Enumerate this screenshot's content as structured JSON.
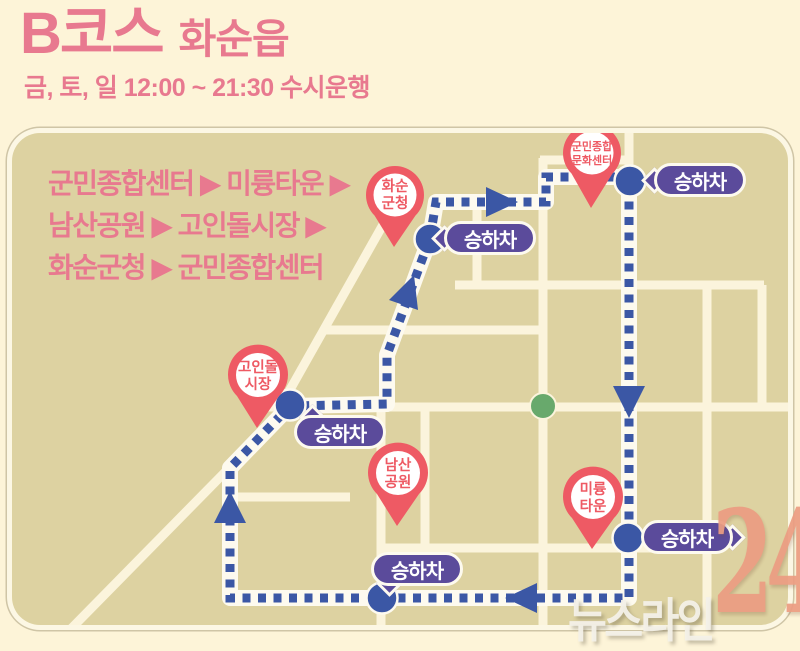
{
  "header": {
    "course": "B코스",
    "area": "화순읍",
    "schedule": "금, 토, 일 12:00 ~ 21:30 수시운행"
  },
  "route_summary": {
    "line1": "군민종합센터 ▶ 미륭타운 ▶",
    "line2": "남산공원 ▶ 고인돌시장 ▶",
    "line3": "화순군청 ▶  군민종합센터"
  },
  "map": {
    "badge_label": "승하차",
    "pins": {
      "hwasun_gunchung": {
        "line1": "화순",
        "line2": "군청"
      },
      "munhwa_center": {
        "line1": "군민종합",
        "line2": "문화센터"
      },
      "goindol_market": {
        "line1": "고인돌",
        "line2": "시장"
      },
      "namsan_park": {
        "line1": "남산",
        "line2": "공원"
      },
      "miryung_town": {
        "line1": "미륭",
        "line2": "타운"
      }
    }
  },
  "watermark": {
    "name": "뉴스라인",
    "number": "24"
  },
  "colors": {
    "title_pink": "#e8798f",
    "pin_red": "#ee5a64",
    "badge_purple": "#5b4b9b",
    "route_blue": "#3b57a5",
    "map_khaki": "#ddd2a1",
    "road_cream": "#fbf4dc",
    "park_green": "#68a96c",
    "watermark_salmon": "#ec9d82"
  }
}
